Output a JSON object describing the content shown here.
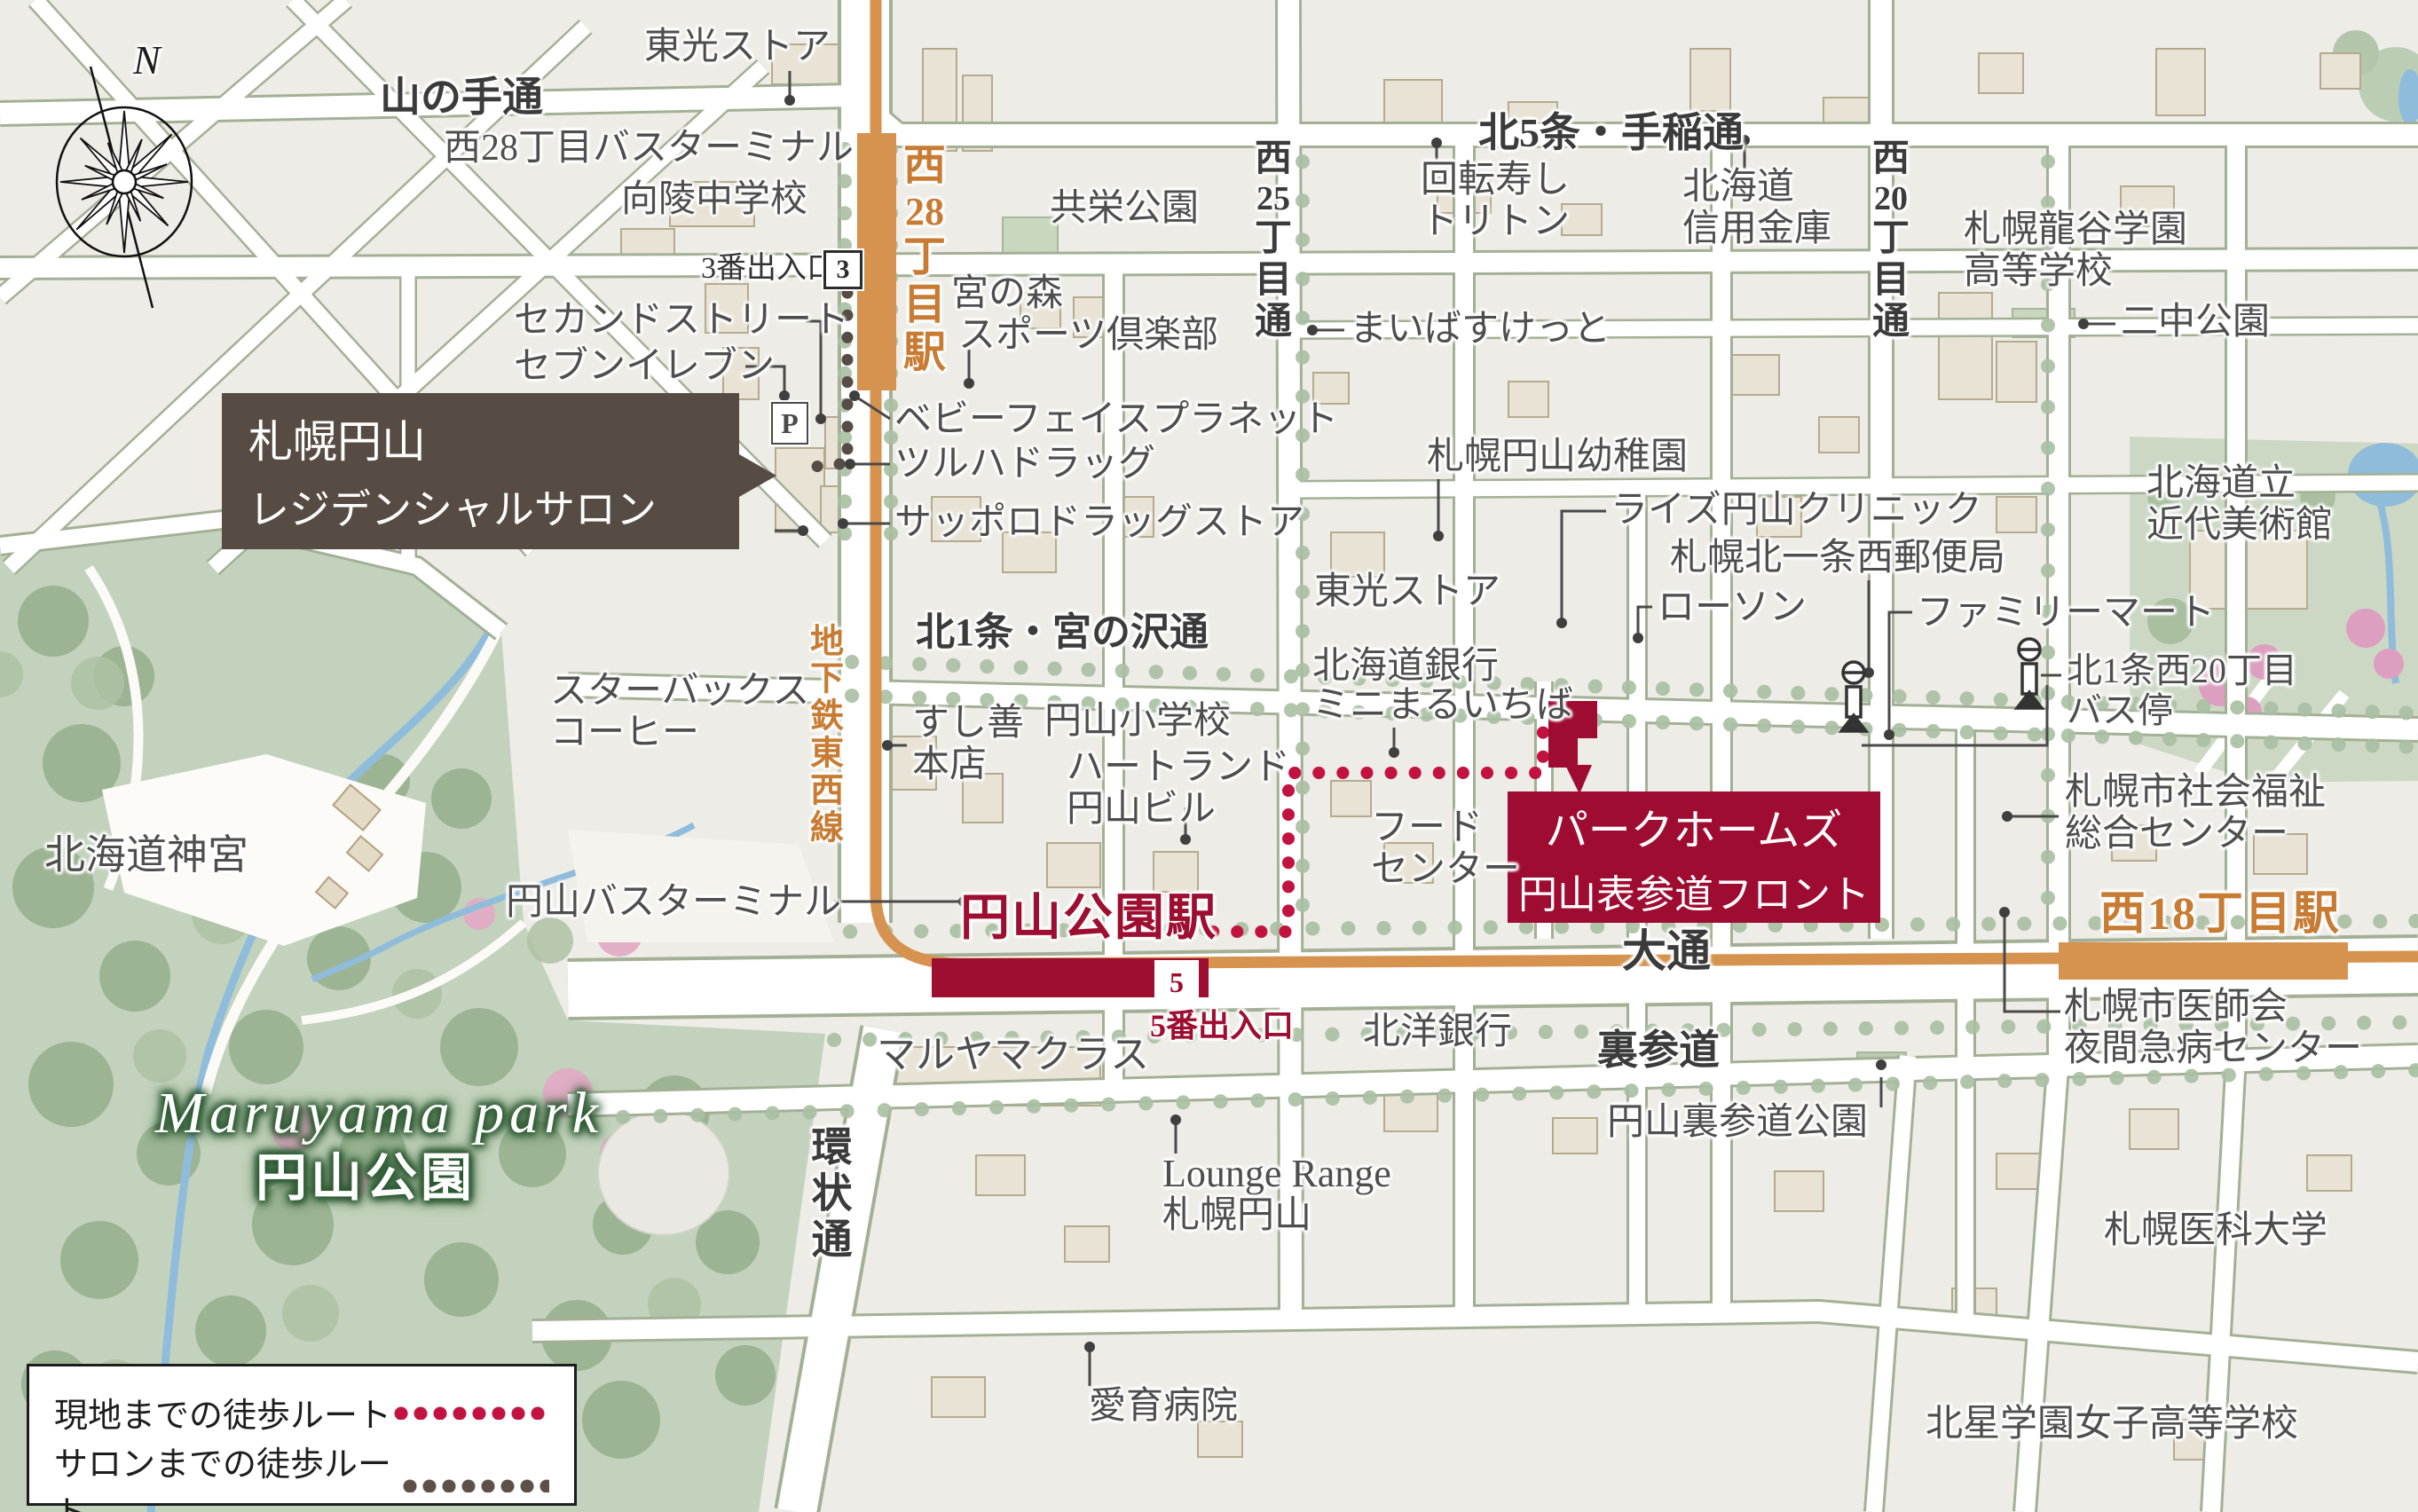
{
  "compass": {
    "north": "N"
  },
  "colors": {
    "site_route": "#c21240",
    "salon_route": "#5c5049",
    "subway_orange": "#d6934f",
    "station_crimson": "#9e0e31",
    "salon_box_brown": "#564c44"
  },
  "legend": {
    "site_route_label": "現地までの徒歩ルート",
    "salon_route_label": "サロンまでの徒歩ルート"
  },
  "highlight": {
    "line1": "パークホームズ",
    "line2": "円山表参道フロント"
  },
  "salon": {
    "line1": "札幌円山",
    "line2": "レジデンシャルサロン"
  },
  "park": {
    "en": "Maruyama park",
    "jp": "円山公園"
  },
  "stations": {
    "w28_segs": [
      "西",
      "28",
      "丁",
      "目",
      "駅"
    ],
    "maruyama_koen": "円山公園駅",
    "w18": "西18丁目駅",
    "exit3": "3番出入口",
    "exit3_badge": "3",
    "exit5": "5番出入口",
    "exit5_badge": "5",
    "subway_line": "地下鉄東西線",
    "parking_badge": "P"
  },
  "roads": {
    "yamanote": "山の手通",
    "kita5": "北5条・手稲通",
    "w25_segs": [
      "西",
      "25",
      "丁",
      "目",
      "通"
    ],
    "w20_segs": [
      "西",
      "20",
      "丁",
      "目",
      "通"
    ],
    "kita1": "北1条・宮の沢通",
    "odori": "大通",
    "urasando": "裏参道",
    "kanjo": "環状通"
  },
  "places": {
    "toko_store_top": "東光ストア",
    "bus_terminal_w28": "西28丁目バスターミナル",
    "koryo": "向陵中学校",
    "second_street": "セカンドストリート",
    "seven_eleven": "セブンイレブン",
    "kyoei_park": "共栄公園",
    "miyanomori1": "宮の森",
    "miyanomori2": "スポーツ倶楽部",
    "kaitenzushi1": "回転寿し",
    "kaitenzushi2": "トリトン",
    "shinkin1": "北海道",
    "shinkin2": "信用金庫",
    "maibasuketto": "まいばすけっと",
    "ryukoku1": "札幌龍谷学園",
    "ryukoku2": "高等学校",
    "nichu_park": "二中公園",
    "babyface": "ベビーフェイスプラネット",
    "tsuruha": "ツルハドラッグ",
    "sapporo_drug": "サッポロドラッグストア",
    "kindergarten": "札幌円山幼稚園",
    "rise_clinic": "ライズ円山クリニック",
    "post_office": "札幌北一条西郵便局",
    "lawson": "ローソン",
    "family_mart": "ファミリーマート",
    "museum1": "北海道立",
    "museum2": "近代美術館",
    "toko_store_2": "東光ストア",
    "hokkaido_bank": "北海道銀行",
    "minimaru": "ミニまるいちば",
    "bus_stop1": "北1条西20丁目",
    "bus_stop2": "バス停",
    "starbucks1": "スターバックス",
    "starbucks2": "コーヒー",
    "sushizen1": "すし善",
    "sushizen2": "本店",
    "maruyama_es": "円山小学校",
    "heartland1": "ハートランド",
    "heartland2": "円山ビル",
    "food_center1": "フード",
    "food_center2": "センター",
    "welfare1": "札幌市社会福祉",
    "welfare2": "総合センター",
    "jingu": "北海道神宮",
    "bus_terminal_maruyama": "円山バスターミナル",
    "maruyama_class": "マルヤマクラス",
    "hokuyo_bank": "北洋銀行",
    "urasando_park": "円山裏参道公園",
    "medical1": "札幌市医師会",
    "medical2": "夜間急病センター",
    "lounge1": "Lounge Range",
    "lounge2": "札幌円山",
    "aiiku": "愛育病院",
    "med_univ": "札幌医科大学",
    "hokusei": "北星学園女子高等学校"
  }
}
